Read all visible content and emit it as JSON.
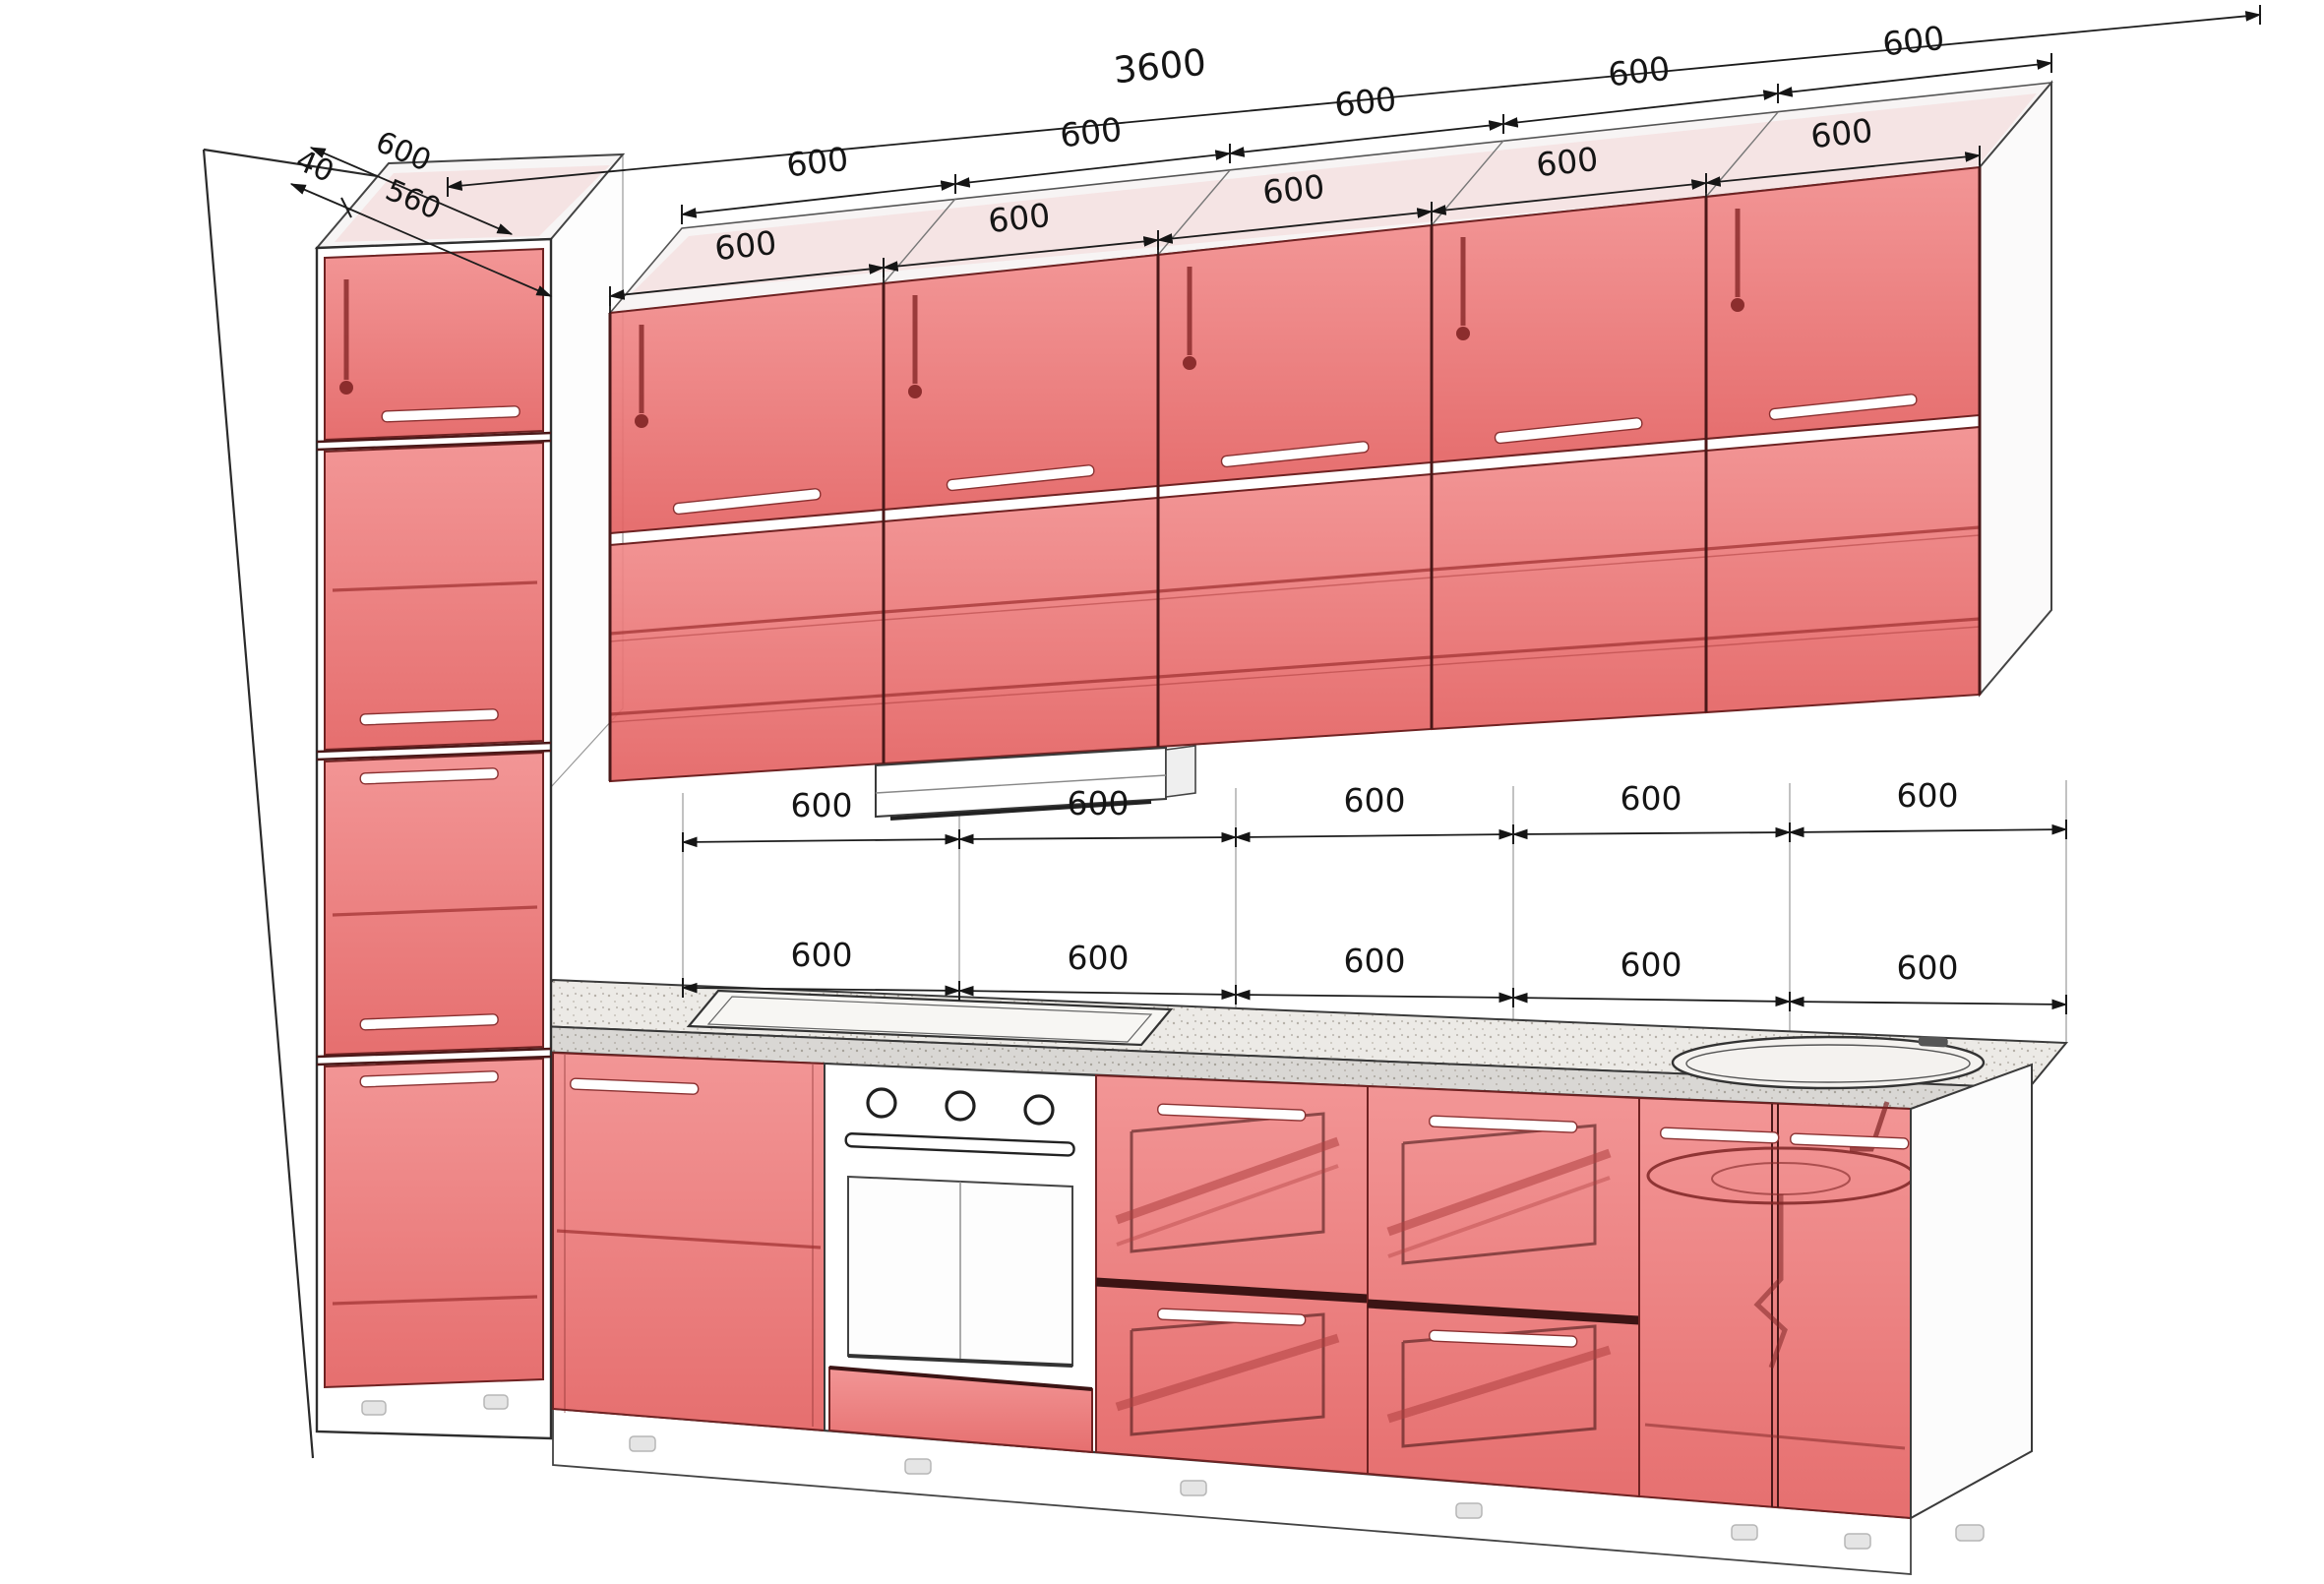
{
  "drawing": {
    "kind": "kitchen-cabinet-isometric-diagram",
    "colors": {
      "front_red": "#e87070",
      "front_red_dark": "#7e2424",
      "line": "#2a2a2a",
      "carcass_white": "#ffffff",
      "counter": "#eceae6"
    }
  },
  "dimensions": {
    "total": "3600",
    "depth_total": "600",
    "depth_gap": "40",
    "depth_cabinet": "560",
    "top_back": [
      "600",
      "600",
      "600",
      "600",
      "600"
    ],
    "top_front": [
      "600",
      "600",
      "600",
      "600",
      "600"
    ],
    "mid_upper": [
      "600",
      "600",
      "600",
      "600",
      "600"
    ],
    "mid_lower": [
      "600",
      "600",
      "600",
      "600",
      "600"
    ]
  }
}
